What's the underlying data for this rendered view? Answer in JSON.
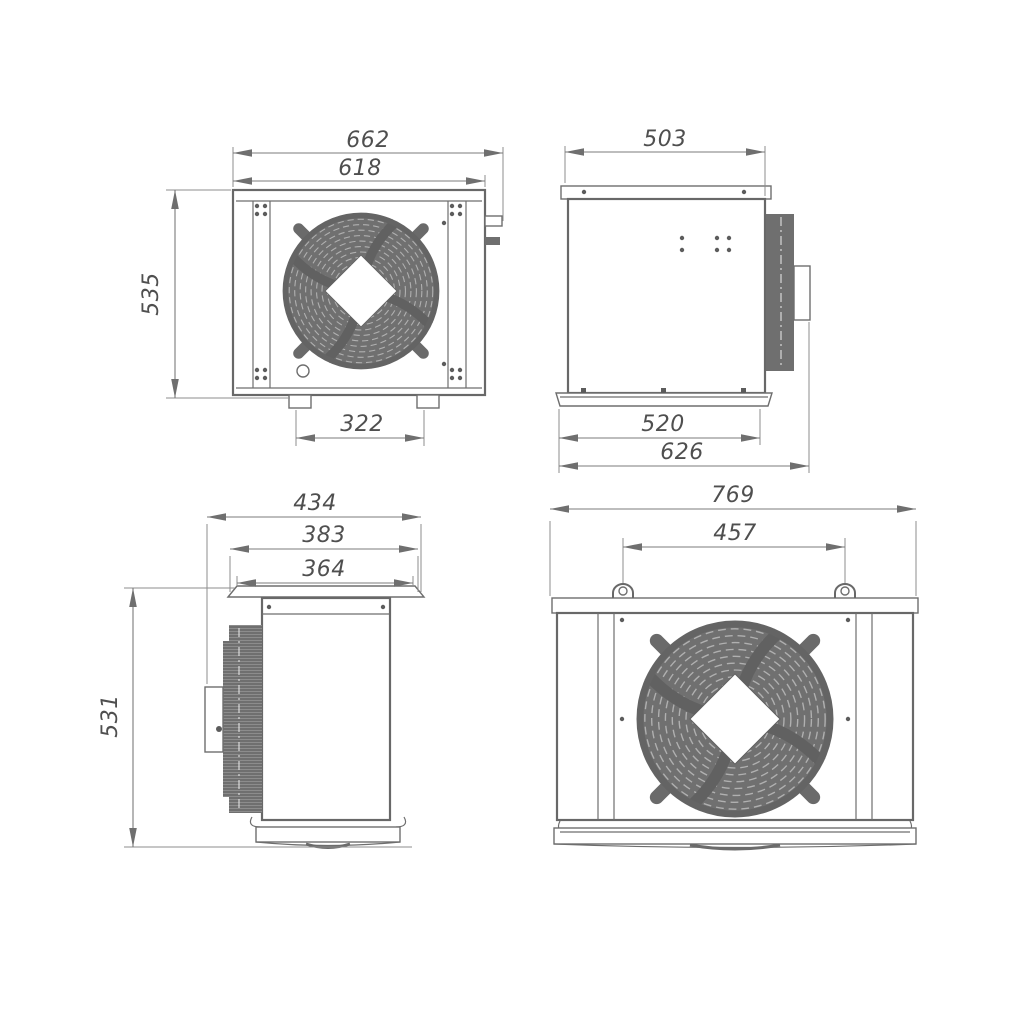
{
  "drawing": {
    "type": "technical-dimension-drawing",
    "subject": "condensing unit, four orthographic views",
    "background": "#ffffff",
    "line_color": "#6a6a6a",
    "dark_fill": "#6f6f6f",
    "views": {
      "front": {
        "label": "front-view",
        "dims": {
          "overall_width": "662",
          "body_width": "618",
          "height": "535",
          "feet_spacing": "322"
        }
      },
      "side": {
        "label": "side-view",
        "dims": {
          "top_width": "503",
          "base_width": "520",
          "overall_depth": "626"
        }
      },
      "profile": {
        "label": "profile-view",
        "dims": {
          "overall_width": "434",
          "flange_width": "383",
          "body_width": "364",
          "height": "531"
        }
      },
      "rear": {
        "label": "rear-view",
        "dims": {
          "overall_width": "769",
          "lug_spacing": "457"
        }
      }
    }
  }
}
